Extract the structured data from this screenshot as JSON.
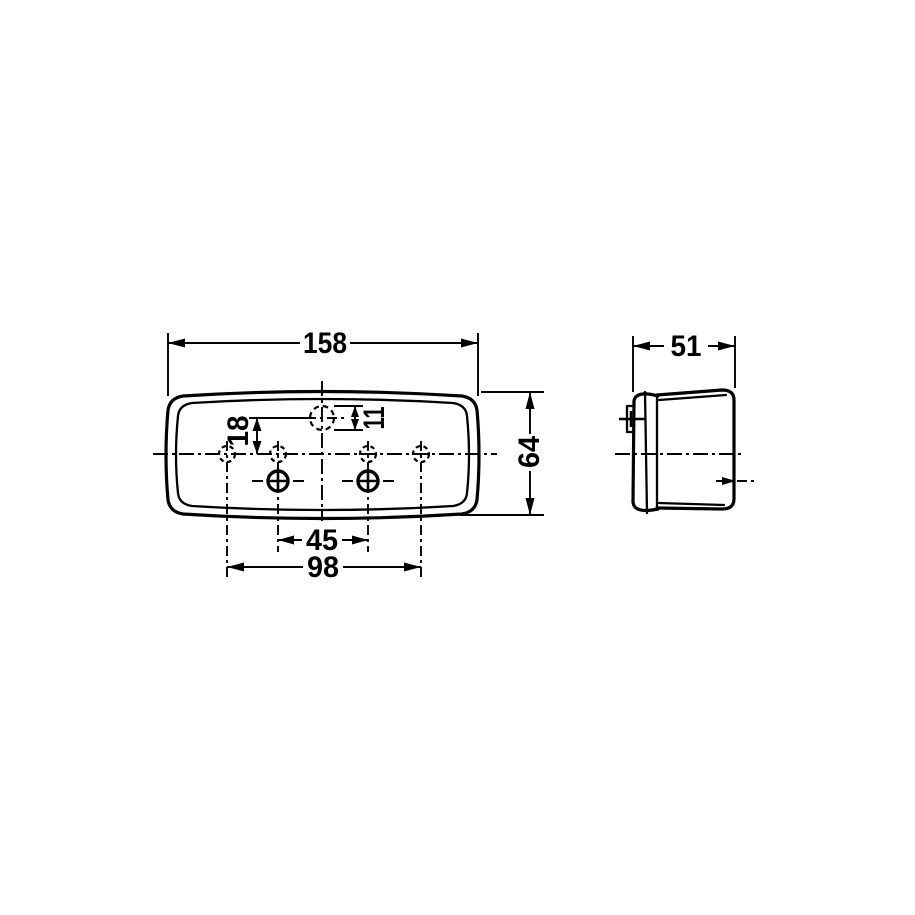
{
  "canvas": {
    "background": "#ffffff",
    "line_color": "#000000"
  },
  "drawing": {
    "front_view": {
      "dim_width": "158",
      "dim_height": "64",
      "dim_center_hole": "11",
      "dim_center_hole_offset": "18",
      "dim_screw_spacing": "45",
      "dim_mount_hole_spacing": "98"
    },
    "side_view": {
      "dim_depth": "51"
    }
  }
}
